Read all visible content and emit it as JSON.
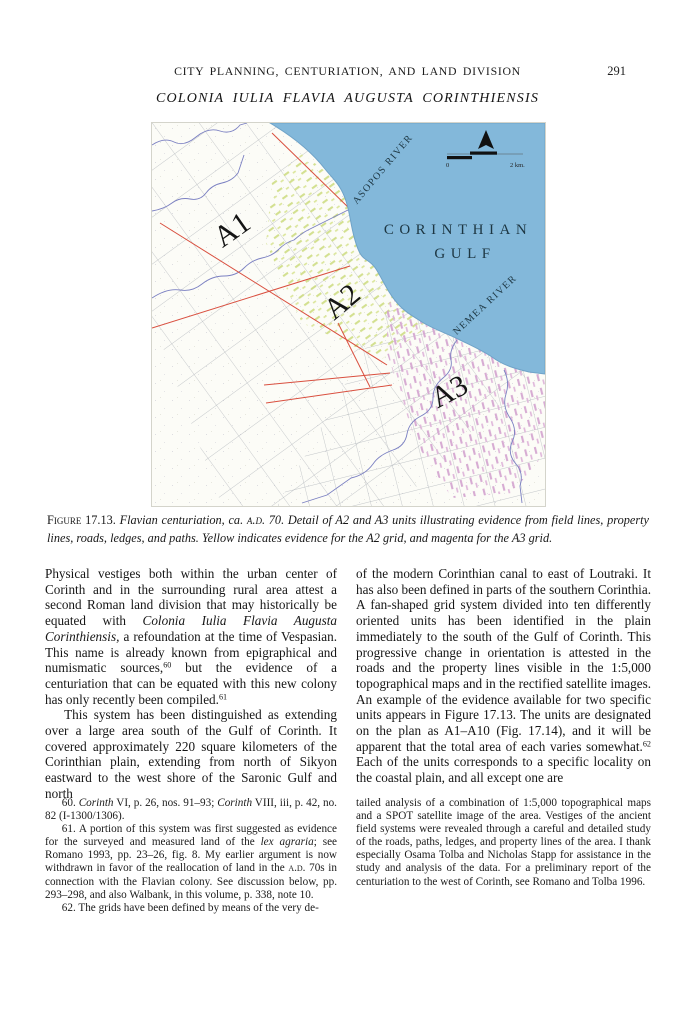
{
  "page": {
    "running_head": "CITY PLANNING, CENTURIATION, AND LAND DIVISION",
    "page_number": "291",
    "title": "COLONIA IULIA FLAVIA AUGUSTA CORINTHIENSIS"
  },
  "figure": {
    "map": {
      "labels": {
        "gulf_line1": "CORINTHIAN",
        "gulf_line2": "GULF",
        "asopos_river": "ASOPOS RIVER",
        "nemea_river": "NEMEA RIVER",
        "unit_a1": "A1",
        "unit_a2": "A2",
        "unit_a3": "A3",
        "scale_zero": "0",
        "scale_max": "2 km."
      },
      "colors": {
        "water": "#83b8da",
        "coastline": "#6fa3c8",
        "land": "#fcfcf7",
        "grid_line": "#a6abb2",
        "red_evidence_line": "#d94f3f",
        "a2_evidence_yellow": "#ccdb7e",
        "a3_evidence_magenta": "#d3a3cf",
        "river_blue": "#7b80c2",
        "label_text": "#1d3642"
      }
    },
    "caption_runs": [
      {
        "t": "Figure 17.13. ",
        "sc": true
      },
      {
        "t": "Flavian centuriation, ca. ",
        "i": true
      },
      {
        "t": "a.d.",
        "i": true,
        "sc": true
      },
      {
        "t": " 70. Detail of A2 and A3 units illustrating evidence from field lines, property lines, roads, ledges, and paths. Yellow indicates evidence for the A2 grid, and magenta for the A3 grid.",
        "i": true
      }
    ]
  },
  "body": {
    "left": {
      "para1_runs": [
        {
          "t": "Physical vestiges both within the urban center of Corinth and in the surrounding rural area attest a second Roman land division that may historically be equated with "
        },
        {
          "t": "Colonia Iulia Flavia Augusta Corinthiensis,",
          "i": true
        },
        {
          "t": " a refoundation at the time of Vespasian. This name is already known from epigraphical and numismatic sources,"
        },
        {
          "t": "60",
          "sup": true
        },
        {
          "t": " but the evidence of a centuriation that can be equated with this new colony has only recently been compiled."
        },
        {
          "t": "61",
          "sup": true
        }
      ],
      "para2_runs": [
        {
          "t": "This system has been distinguished as extending over a large area south of the Gulf of Corinth. It covered approximately 220 square kilometers of the Corinthian plain, extending from north of Sikyon eastward to the west shore of the Saronic Gulf and north"
        }
      ]
    },
    "right": {
      "para_runs": [
        {
          "t": "of the modern Corinthian canal to east of Loutraki. It has also been defined in parts of the southern Corinthia. A fan-shaped grid system divided into ten differently oriented units has been identified in the plain immediately to the south of the Gulf of Corinth. This progressive change in orientation is attested in the roads and the property lines visible in the 1:5,000 topographical maps and in the rectified satellite images. An example of the evidence available for two specific units appears in Figure 17.13. The units are designated on the plan as A1–A10 (Fig. 17.14), and it will be apparent that the total area of each varies somewhat."
        },
        {
          "t": "62",
          "sup": true
        },
        {
          "t": " Each of the units corresponds to a specific locality on the coastal plain, and all except one are"
        }
      ]
    }
  },
  "footnotes": {
    "left": {
      "note60_runs": [
        {
          "t": "60. "
        },
        {
          "t": "Corinth",
          "i": true
        },
        {
          "t": " VI, p. 26, nos. 91–93; "
        },
        {
          "t": "Corinth",
          "i": true
        },
        {
          "t": " VIII, iii, p. 42, no. 82 (I-1300/1306)."
        }
      ],
      "note61_runs": [
        {
          "t": "61. A portion of this system was first suggested as evidence for the surveyed and measured land of the "
        },
        {
          "t": "lex agraria",
          "i": true
        },
        {
          "t": "; see Romano 1993, pp. 23–26, fig. 8. My earlier argument is now withdrawn in favor of the reallocation of land in the "
        },
        {
          "t": "a.d.",
          "sc": true
        },
        {
          "t": " 70s in connection with the Flavian colony. See discussion below, pp. 293–298, and also Walbank, in this volume, p. 338, note 10."
        }
      ],
      "note62_runs": [
        {
          "t": "62. The grids have been defined by means of the very de-"
        }
      ]
    },
    "right": {
      "note62_cont_runs": [
        {
          "t": "tailed analysis of a combination of 1:5,000 topographical maps and a SPOT satellite image of the area. Vestiges of the ancient field systems were revealed through a careful and detailed study of the roads, paths, ledges, and property lines of the area. I thank especially Osama Tolba and Nicholas Stapp for assistance in the study and analysis of the data. For a preliminary report of the centuriation to the west of Corinth, see Romano and Tolba 1996."
        }
      ]
    }
  }
}
